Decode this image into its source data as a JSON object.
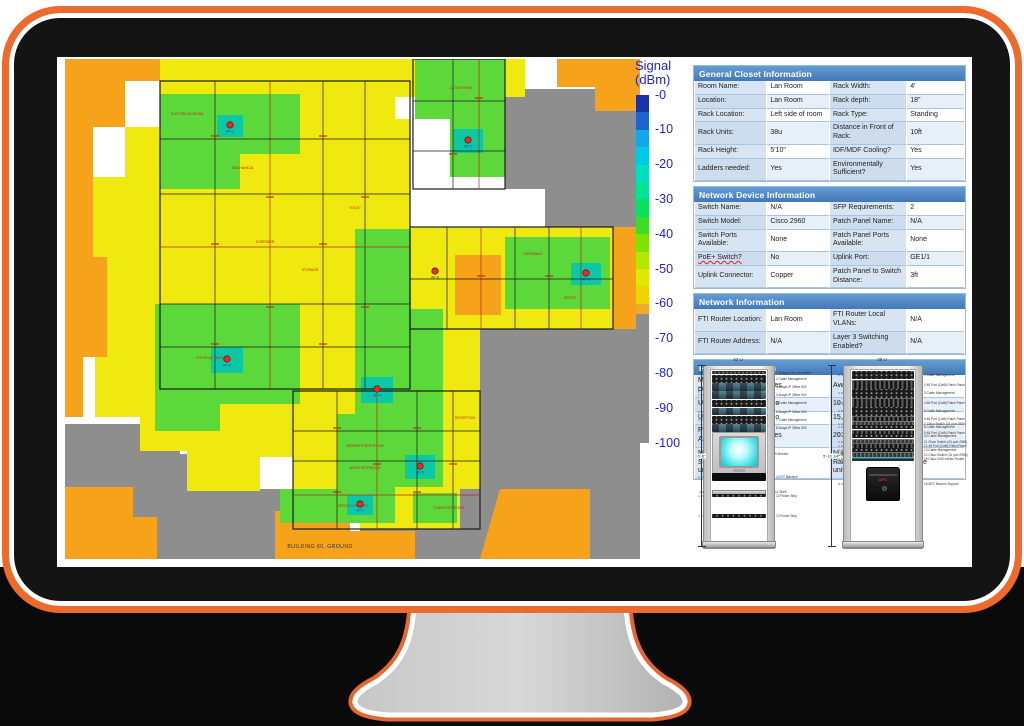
{
  "floorplan": {
    "caption": "BUILDING 60, GROUND",
    "colors": {
      "yellow": "#F0E90F",
      "orange": "#F6A31B",
      "gray": "#8E8E8E",
      "green": "#5CD83B",
      "teal": "#0CC9A4",
      "wall": "#1a1a1a",
      "red": "#C02418",
      "ap_label": "#1040E0"
    },
    "gray_zones": [
      [
        440,
        30,
        575,
        30,
        575,
        168,
        480,
        168,
        480,
        130,
        440,
        130
      ],
      [
        415,
        270,
        575,
        270,
        575,
        500,
        295,
        500,
        295,
        468,
        350,
        468,
        350,
        430,
        395,
        430,
        395,
        330,
        415,
        330
      ],
      [
        0,
        365,
        115,
        365,
        115,
        395,
        185,
        395,
        185,
        430,
        255,
        430,
        255,
        500,
        0,
        500
      ]
    ],
    "yellow_zones": [
      [
        95,
        0,
        460,
        0,
        460,
        38,
        330,
        38,
        330,
        80,
        300,
        80,
        300,
        22,
        95,
        22
      ],
      [
        60,
        22,
        300,
        22,
        300,
        60,
        345,
        60,
        345,
        168,
        360,
        168,
        360,
        332,
        268,
        332,
        268,
        368,
        228,
        368,
        228,
        398,
        195,
        398,
        195,
        432,
        122,
        432,
        122,
        392,
        75,
        392,
        75,
        358,
        30,
        358,
        30,
        298,
        42,
        298,
        42,
        198,
        28,
        198,
        28,
        118,
        60,
        118,
        60,
        68,
        95,
        68,
        95,
        22
      ],
      [
        345,
        168,
        548,
        168,
        548,
        270,
        415,
        270,
        415,
        332,
        345,
        332
      ],
      [
        228,
        332,
        415,
        332,
        415,
        430,
        395,
        430,
        395,
        470,
        295,
        470,
        295,
        440,
        228,
        440
      ],
      [
        250,
        430,
        298,
        430,
        298,
        455,
        250,
        455
      ]
    ],
    "orange_zones": [
      [
        0,
        0,
        95,
        0,
        95,
        22,
        60,
        22,
        60,
        68,
        28,
        68,
        28,
        118,
        0,
        118
      ],
      [
        0,
        118,
        28,
        118,
        28,
        198,
        42,
        198,
        42,
        298,
        18,
        298,
        18,
        358,
        0,
        358
      ],
      [
        492,
        0,
        575,
        0,
        575,
        52,
        530,
        52,
        530,
        28,
        492,
        28
      ],
      [
        548,
        168,
        575,
        168,
        575,
        270,
        548,
        270
      ],
      [
        0,
        428,
        68,
        428,
        68,
        458,
        92,
        458,
        92,
        500,
        0,
        500
      ],
      [
        210,
        452,
        285,
        452,
        285,
        472,
        350,
        472,
        350,
        500,
        210,
        500
      ],
      [
        435,
        430,
        525,
        430,
        525,
        500,
        415,
        500
      ],
      [
        390,
        196,
        436,
        196,
        436,
        256,
        390,
        256
      ]
    ],
    "green_zones": [
      [
        95,
        35,
        235,
        35,
        235,
        95,
        175,
        95,
        175,
        130,
        95,
        130
      ],
      [
        350,
        0,
        440,
        0,
        440,
        118,
        385,
        118,
        385,
        60,
        350,
        60
      ],
      [
        90,
        245,
        235,
        245,
        235,
        345,
        155,
        345,
        155,
        372,
        90,
        372
      ],
      [
        290,
        170,
        345,
        170,
        345,
        250,
        378,
        250,
        378,
        428,
        330,
        428,
        330,
        462,
        272,
        462,
        272,
        355,
        290,
        355
      ],
      [
        440,
        178,
        545,
        178,
        545,
        250,
        440,
        250
      ],
      [
        215,
        430,
        330,
        430,
        330,
        464,
        215,
        464
      ],
      [
        348,
        434,
        392,
        434,
        392,
        464,
        348,
        464
      ]
    ],
    "teal_spots": [
      [
        152,
        56,
        26,
        22
      ],
      [
        388,
        70,
        30,
        24
      ],
      [
        146,
        288,
        32,
        26
      ],
      [
        296,
        318,
        32,
        26
      ],
      [
        340,
        396,
        30,
        24
      ],
      [
        506,
        204,
        30,
        22
      ],
      [
        282,
        436,
        26,
        20
      ]
    ],
    "room_zones": [
      {
        "rect": [
          95,
          22,
          250,
          308
        ],
        "v": [
          150,
          205,
          258,
          300
        ],
        "h": [
          80,
          135,
          188,
          245,
          288
        ]
      },
      {
        "rect": [
          345,
          168,
          203,
          102
        ],
        "v": [
          382,
          416,
          450,
          484,
          516
        ],
        "h": [
          220
        ]
      },
      {
        "rect": [
          228,
          332,
          187,
          138
        ],
        "v": [
          272,
          312,
          352,
          388
        ],
        "h": [
          372,
          402,
          436
        ]
      },
      {
        "rect": [
          348,
          0,
          92,
          130
        ],
        "v": [
          388,
          414
        ],
        "h": [
          42,
          92
        ]
      }
    ],
    "room_labels": [
      {
        "t": "ELECTRICAL ROOM",
        "x": 122,
        "y": 56
      },
      {
        "t": "MECHANICAL",
        "x": 178,
        "y": 110
      },
      {
        "t": "STORAGE",
        "x": 245,
        "y": 212
      },
      {
        "t": "CORRIDOR",
        "x": 200,
        "y": 184
      },
      {
        "t": "TOILET",
        "x": 290,
        "y": 150
      },
      {
        "t": "PHYSICAL THERAPY",
        "x": 148,
        "y": 300
      },
      {
        "t": "ACTIVITY RM",
        "x": 396,
        "y": 30
      },
      {
        "t": "VESTIBULE",
        "x": 468,
        "y": 196
      },
      {
        "t": "OFFICE",
        "x": 505,
        "y": 240
      },
      {
        "t": "RECEPTION",
        "x": 400,
        "y": 360
      },
      {
        "t": "WOMEN'S RESTROOM",
        "x": 300,
        "y": 388
      },
      {
        "t": "MEN'S RESTROOM",
        "x": 300,
        "y": 410
      },
      {
        "t": "SPEECH THERAPY",
        "x": 288,
        "y": 448
      },
      {
        "t": "COMPUTER ROOM",
        "x": 384,
        "y": 450
      }
    ],
    "aps": [
      {
        "label": "AP-1",
        "x": 165,
        "y": 66
      },
      {
        "label": "AP-2",
        "x": 403,
        "y": 81
      },
      {
        "label": "AP-3",
        "x": 162,
        "y": 300
      },
      {
        "label": "AP-4",
        "x": 312,
        "y": 330
      },
      {
        "label": "AP-5",
        "x": 355,
        "y": 407
      },
      {
        "label": "AP-6",
        "x": 521,
        "y": 214
      },
      {
        "label": "AP-7",
        "x": 295,
        "y": 445
      },
      {
        "label": "AP-8",
        "x": 370,
        "y": 212
      }
    ]
  },
  "legend": {
    "title_line1": "Signal",
    "title_line2": "(dBm)",
    "ticks": [
      "-0",
      "-10",
      "-20",
      "-30",
      "-40",
      "-50",
      "-60",
      "-70",
      "-80",
      "-90",
      "-100"
    ],
    "segments": [
      {
        "span": 5,
        "color": "#1832A8"
      },
      {
        "span": 5,
        "color": "#1E62CE"
      },
      {
        "span": 5,
        "color": "#0FA8E8"
      },
      {
        "span": 5,
        "color": "#00C9E2"
      },
      {
        "span": 5,
        "color": "#00DFC0"
      },
      {
        "span": 5,
        "color": "#00E494"
      },
      {
        "span": 5,
        "color": "#0ADF5E"
      },
      {
        "span": 5,
        "color": "#3CDC28"
      },
      {
        "span": 5,
        "color": "#7CE400"
      },
      {
        "span": 5,
        "color": "#B2E800"
      },
      {
        "span": 5,
        "color": "#E0E800"
      },
      {
        "span": 5,
        "color": "#EFD400"
      },
      {
        "span": 3,
        "color": "#F2AA26"
      },
      {
        "span": 37,
        "color": "#8E8E8E"
      }
    ]
  },
  "tables": {
    "squiggle_labels": [
      "PoE+ Switch?"
    ],
    "sections": [
      {
        "title": "General Closet Information",
        "rows": [
          [
            "Room Name:",
            "Lan Room",
            "Rack Width:",
            "4'"
          ],
          [
            "Location:",
            "Lan Room",
            "Rack depth:",
            "18\""
          ],
          [
            "Rack Location:",
            "Left side of room",
            "Rack Type:",
            "Standing"
          ],
          [
            "Rack Units:",
            "38u",
            "Distance in Front of Rack:",
            "10ft"
          ],
          [
            "Rack Height:",
            "5'10\"",
            "IDF/MDF Cooling?",
            "Yes"
          ],
          [
            "Ladders needed:",
            "Yes",
            "Environmentally Sufficient?",
            "Yes"
          ]
        ]
      },
      {
        "title": "Network Device Information",
        "rows": [
          [
            "Switch Name:",
            "N/A",
            "SFP Requirements:",
            "2"
          ],
          [
            "Switch Model:",
            "Cisco 2960",
            "Patch Panel Name:",
            "N/A"
          ],
          [
            "Switch Ports Available:",
            "None",
            "Patch Panel Ports Available:",
            "None"
          ],
          [
            "PoE+ Switch?",
            "No",
            "Uplink Port:",
            "GE1/1"
          ],
          [
            "Uplink Connector:",
            "Copper",
            "Patch Panel to Switch Distance:",
            "3ft"
          ]
        ]
      },
      {
        "title": "Network Information",
        "rows": [
          [
            "FTI Router Location:",
            "Lan Room",
            "FTI Router Local VLANs:",
            "N/A"
          ],
          [
            "FTI Router Address:",
            "N/A",
            "Layer 3 Switching Enabled?",
            "N/A"
          ]
        ]
      },
      {
        "title": "Power Information",
        "rows": [
          [
            "May we use critical power?",
            "Yes",
            "Avaliable Outlets:",
            "15"
          ],
          [
            "UPS Avaliable:",
            "No",
            "10 Amp Outlets:",
            ""
          ],
          [
            "UPS Avaliable:",
            "No",
            "15 Amp Outlets:",
            "7"
          ],
          [
            "Power Strips Avaliable:",
            "Yes",
            "20 Amp Outlets:",
            "8"
          ],
          [
            "Number of Additional Standalone UPS units required:",
            "1",
            "Number of Additional Rack-Mounted UPS units required:",
            "None"
          ]
        ]
      }
    ]
  },
  "racks": [
    {
      "title": "42 U",
      "slots": 42,
      "x": 6,
      "w": 70,
      "dims": [
        {
          "x": -2,
          "label": "6'-6\""
        },
        {
          "x": 128,
          "label": "5'-10 1/4\""
        }
      ],
      "items": [
        {
          "u": 1,
          "type": "switch",
          "label": "Netgear 24 port switch"
        },
        {
          "u": 2,
          "type": "cable",
          "label": "Cable Management"
        },
        {
          "u": 2,
          "type": "avaya",
          "label": "Avaya IP Office 500"
        },
        {
          "u": 2,
          "type": "avaya",
          "label": "Avaya IP Office 500"
        },
        {
          "u": 2,
          "type": "cable",
          "label": "Cable Management"
        },
        {
          "u": 2,
          "type": "avaya",
          "label": "Avaya IP Office 500"
        },
        {
          "u": 2,
          "type": "cable",
          "label": "Cable Management"
        },
        {
          "u": 2,
          "type": "avaya",
          "label": "Avaya IP Office 500"
        },
        {
          "u": 10,
          "type": "monitor",
          "label": "Monitor"
        },
        {
          "u": 2,
          "type": "pc",
          "label": "PC Machine"
        },
        {
          "u": 2,
          "type": "gap",
          "label": ""
        },
        {
          "u": 1,
          "type": "shelf",
          "label": "Shelf"
        },
        {
          "u": 1,
          "type": "power",
          "label": "Power Strip"
        },
        {
          "u": 4,
          "type": "gap",
          "label": ""
        },
        {
          "u": 1,
          "type": "power",
          "label": "Power Strip"
        }
      ]
    },
    {
      "title": "38 U",
      "slots": 38,
      "x": 146,
      "w": 78,
      "dims": [
        {
          "x": 138,
          "label": "74\""
        }
      ],
      "items": [
        {
          "u": 2,
          "type": "cable",
          "label": "Cable Management"
        },
        {
          "u": 2,
          "type": "panel",
          "label": "48 Port (Cat6) Patch Panel"
        },
        {
          "u": 2,
          "type": "cable",
          "label": "Cable Management"
        },
        {
          "u": 2,
          "type": "panel",
          "label": "48 Port (Cat6) Patch Panel"
        },
        {
          "u": 2,
          "type": "cable",
          "label": "Cable Management"
        },
        {
          "u": 1,
          "type": "panel",
          "label": "48 Port (Cat6) Patch Panel"
        },
        {
          "u": 1,
          "type": "cisco",
          "label": "Cisco Switch (24 port 2960)"
        },
        {
          "u": 1,
          "type": "cable",
          "label": "Cable Management"
        },
        {
          "u": 1,
          "type": "panel",
          "label": "48 Port (Cat6) Patch Panel"
        },
        {
          "u": 1,
          "type": "cable",
          "label": "Cable Management"
        },
        {
          "u": 1,
          "type": "cisco",
          "label": "Cisco Switch (24 port 2960)"
        },
        {
          "u": 1,
          "type": "panel",
          "label": "48 Port (Cat6) Patch Panel"
        },
        {
          "u": 1,
          "type": "cable",
          "label": "Cable Management"
        },
        {
          "u": 1,
          "type": "cisco",
          "label": "Cisco Switch (24 port 2960)"
        },
        {
          "u": 1,
          "type": "router",
          "label": "Cisco 4300 series Router"
        },
        {
          "u": 1,
          "type": "gap",
          "label": ""
        },
        {
          "u": 8,
          "type": "ups",
          "label": "APC Mission Support"
        }
      ]
    }
  ]
}
